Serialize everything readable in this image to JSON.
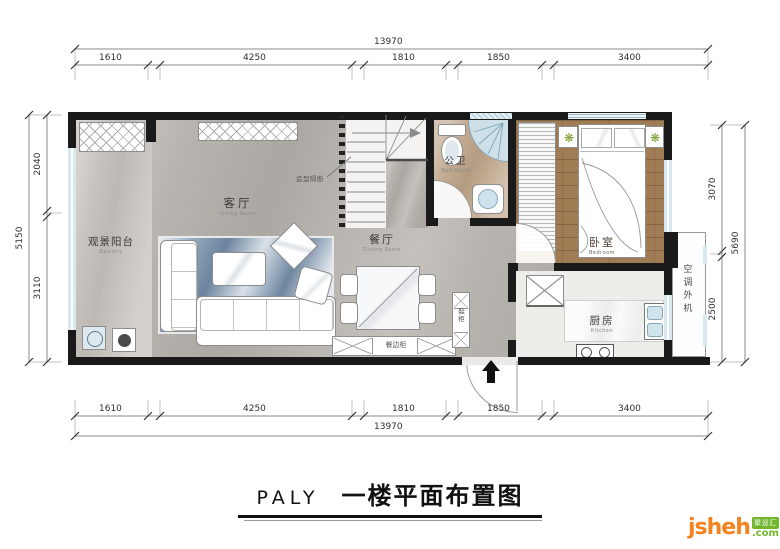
{
  "title": {
    "prefix": "PALY",
    "text": "一楼平面布置图"
  },
  "dimensions": {
    "top": {
      "total": "13970",
      "segments": [
        "1610",
        "4250",
        "1810",
        "1850",
        "3400"
      ]
    },
    "bottom": {
      "total": "13970",
      "segments": [
        "1610",
        "4250",
        "1810",
        "1850",
        "3400"
      ]
    },
    "left": {
      "total": "5150",
      "segments": [
        "2040",
        "3110"
      ]
    },
    "right": {
      "total": "5690",
      "segments": [
        "3070",
        "2500"
      ]
    }
  },
  "rooms": {
    "balcony": {
      "cn": "观景阳台",
      "en": "Balcony"
    },
    "living": {
      "cn": "客厅",
      "en": "Living Room"
    },
    "dining": {
      "cn": "餐厅",
      "en": "Dining Room"
    },
    "bathroom": {
      "cn": "公卫",
      "en": "BathRoom"
    },
    "bedroom": {
      "cn": "卧室",
      "en": "Bedroom"
    },
    "kitchen": {
      "cn": "厨房",
      "en": "Kitchen"
    },
    "ac_platform": {
      "cn": "空调外机"
    }
  },
  "annotations": {
    "partition": "造型隔断",
    "sideboard": "餐边柜",
    "shoe_cabinet": "鞋柜"
  },
  "logo": {
    "brand": "jsheh",
    "badge": "聚设汇",
    "tld": ".com"
  },
  "colors": {
    "wall": "#1a1a1a",
    "orange": "#f5831f",
    "green": "#72b62c",
    "window": "#d7e8ef",
    "wood": "#a07c55"
  }
}
